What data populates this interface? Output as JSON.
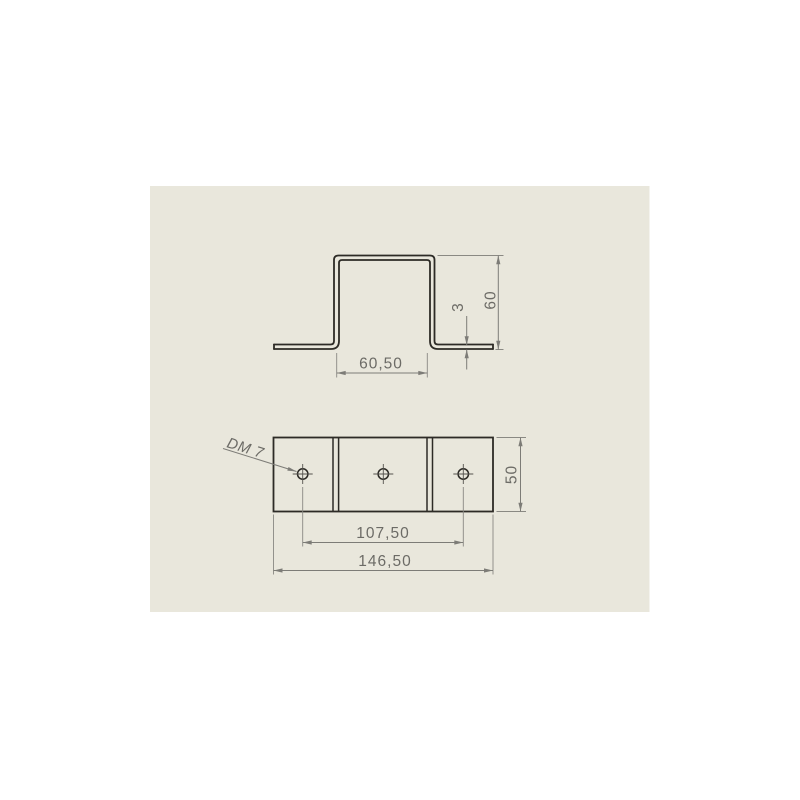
{
  "drawing": {
    "front_view": {
      "dims": {
        "inner_width": "60,50",
        "flange_thickness": "3",
        "height": "60"
      }
    },
    "plan_view": {
      "dims": {
        "hole_note": "DM 7",
        "depth": "50",
        "hole_spacing": "107,50",
        "overall_width": "146,50"
      }
    },
    "colors": {
      "canvas_background": "#ffffff",
      "sheet_background": "#e9e7dc",
      "part_edge": "#2d2b26",
      "dimension_line": "#7d7c77",
      "dimension_text": "#6c6b66"
    }
  }
}
